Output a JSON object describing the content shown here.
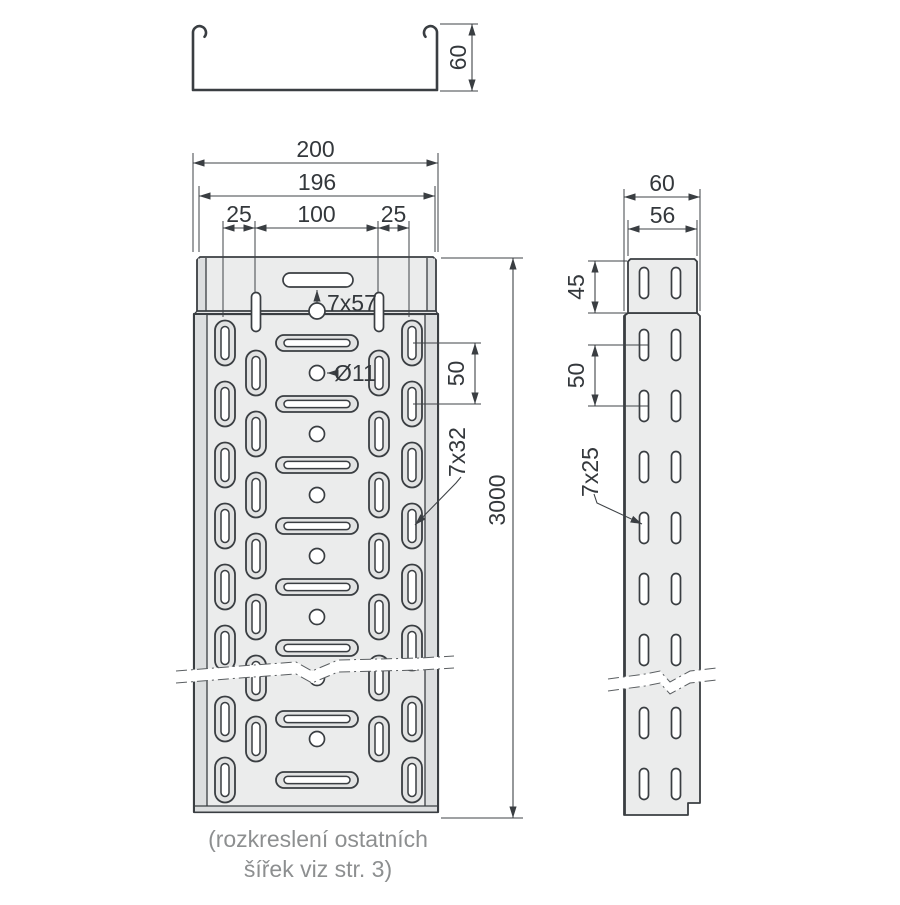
{
  "drawing": {
    "caption_line1": "(rozkreslení ostatních",
    "caption_line2": "šířek viz str. 3)",
    "cross_section": {
      "height": "60"
    },
    "front_view": {
      "width": "200",
      "body_width": "196",
      "edge_offset_left": "25",
      "center_spacing": "100",
      "edge_offset_right": "25",
      "end_slot": "7x57",
      "hole": "Ø11",
      "row_pitch": "50",
      "length": "3000",
      "side_slot": "7x32"
    },
    "side_view": {
      "height": "60",
      "end_height": "56",
      "end_section": "45",
      "row_pitch": "50",
      "slot": "7x25"
    },
    "colors": {
      "outline": "#3a3e42",
      "plate": "#ebecec",
      "edge_shade": "#dcdedf",
      "caption_gray": "#8d8f90"
    }
  }
}
